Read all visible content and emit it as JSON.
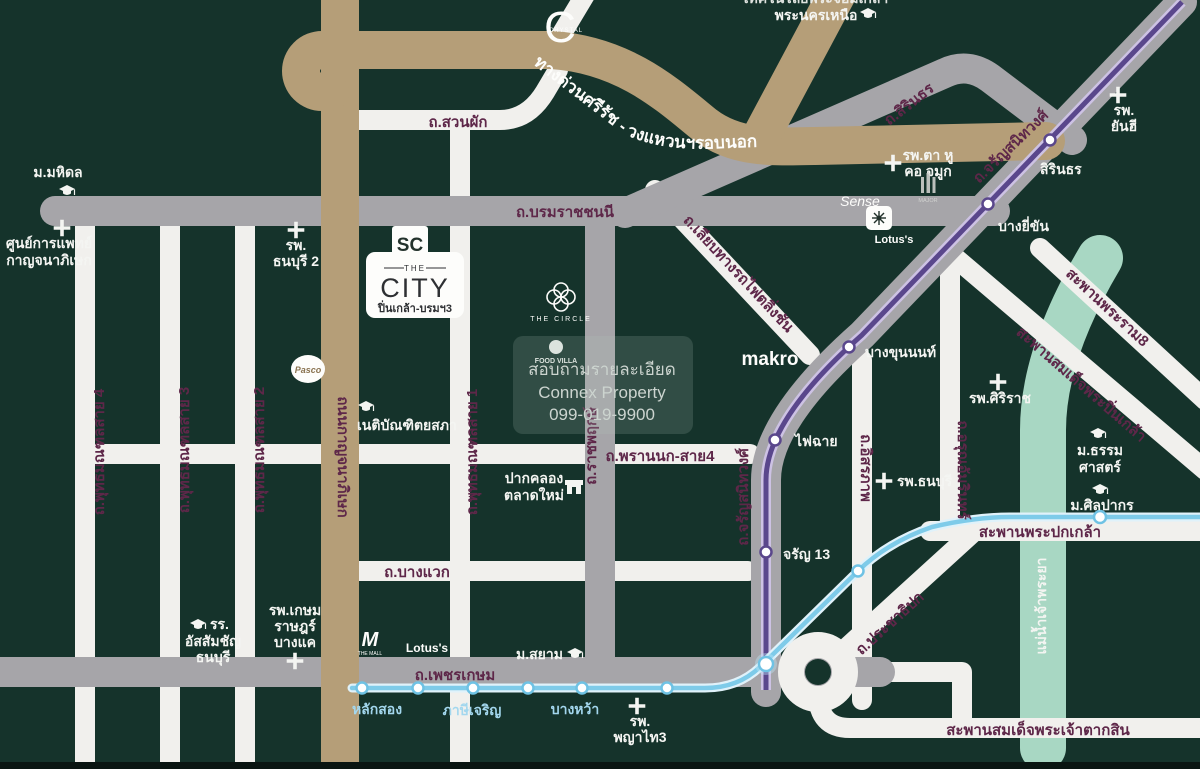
{
  "map_title": "The City Pinklao - Borom location map",
  "colors": {
    "background": "#15332b",
    "road_white": "#f1f0ed",
    "road_gray": "#a6a5a9",
    "expressway_tan": "#b59e78",
    "river_teal": "#a8d7c3",
    "mrt_purple": "#5a478c",
    "mrt_blue": "#7ecbe9",
    "road_label_maroon": "#5e2749"
  },
  "roads": {
    "suanphak": "ถ.สวนผัก",
    "borommaratchachonnani": "ถ.บรมราชชนนี",
    "sirinthon": "ถ.สิรินธร",
    "charansanitwong_upper": "ถ.จรัญสนิทวงศ์",
    "charansanitwong_lower": "ถ.จรัญสนิทวงศ์",
    "liap_railway": "ถ.เลียบทางรถไฟตลิ่งชัน",
    "phutthamonthon4": "ถ.พุทธมณฑลสาย 4",
    "phutthamonthon3": "ถ.พุทธมณฑลสาย 3",
    "phutthamonthon2": "ถ.พุทธมณฑลสาย 2",
    "phutthamonthon1": "ถ.พุทธมณฑลสาย 1",
    "kanchanaphisek": "ถนนกาญจนาภิเษก",
    "ratchaphruek": "ถ.ราชพฤกษ์",
    "phran_nok": "ถ.พรานนก-สาย4",
    "bang_waek": "ถ.บางแวก",
    "phetkasem": "ถ.เพชรเกษม",
    "itsaraphap": "ถ.อิสรภาพ",
    "arun_amarin": "ถ.อรุณอัมรินทร์",
    "prachathipok": "ถ.ประชาธิปก",
    "expressway": "ทางด่วนศรีรัช - วงแหวนฯรอบนอก"
  },
  "bridges": {
    "rama8": "สะพานพระราม8",
    "pinklao": "สะพานสมเด็จพระปิ่นเกล้า",
    "phra_pokklao": "สะพานพระปกเกล้า",
    "taksin": "สะพานสมเด็จพระเจ้าตากสิน"
  },
  "river": {
    "name": "แม่น้ำเจ้าพระยา"
  },
  "transit": {
    "purple_stations": {
      "sirinthon": "สิรินธร",
      "bang_yi_khan": "บางยี่ขัน",
      "bang_khun_non": "บางขุนนนท์",
      "fai_chai": "ไฟฉาย",
      "charan13": "จรัญ 13"
    },
    "blue_stations": {
      "lak_song": "หลักสอง",
      "phasi_charoen": "ภาษีเจริญ",
      "bang_wa": "บางหว้า"
    }
  },
  "places": {
    "mahidol": "ม.มหิดล",
    "golden_jubilee_1": "ศูนย์การแพทย์",
    "golden_jubilee_2": "กาญจนาภิเษก",
    "thonburi2_1": "รพ.",
    "thonburi2_2": "ธนบุรี 2",
    "netibandit": "เนติบัณฑิตยสภา",
    "north_tech_partial": "เทคโนโลยีพระจอมเกล้า",
    "north_bangkok_univ": "พระนครเหนือ",
    "ent_hospital_1": "รพ.ตา หู",
    "ent_hospital_2": "คอ จมูก",
    "yanhee_1": "รพ.",
    "yanhee_2": "ยันฮี",
    "pak_khlong_1": "ปากคลอง",
    "pak_khlong_2": "ตลาดใหม่",
    "siriraj": "รพ.ศิริราช",
    "thonburi_hospital": "รพ.ธนบุรี",
    "thammasat_1": "ม.ธรรม",
    "thammasat_2": "ศาสตร์",
    "silpakorn": "ม.ศิลปากร",
    "siam_univ": "ม.สยาม",
    "assumption_1": "รร.",
    "assumption_2": "อัสสัมชัญ",
    "assumption_3": "ธนบุรี",
    "kasemrad_1": "รพ.เกษม",
    "kasemrad_2": "ราษฎร์",
    "kasemrad_3": "บางแค",
    "phyathai3_1": "รพ.",
    "phyathai3_2": "พญาไท3"
  },
  "brands": {
    "crystal_letter": "C",
    "crystal": "CRYSTAL",
    "sc": "SC",
    "project_the": "THE",
    "project_name": "CITY",
    "project_sub": "ปิ่นเกล้า-บรมฯ3",
    "circle": "THE CIRCLE",
    "pasco": "Pasco",
    "food_villa": "FOOD VILLA",
    "makro": "makro",
    "sense": "Sense",
    "major": "MAJOR",
    "lotus_top": "Lotus's",
    "mall_letter": "M",
    "mall_sub": "THE MALL",
    "lotus_bottom": "Lotus's"
  },
  "watermark": {
    "line1": "สอบถามรายละเอียด",
    "line2": "Connex Property",
    "line3": "099-019-9900"
  }
}
